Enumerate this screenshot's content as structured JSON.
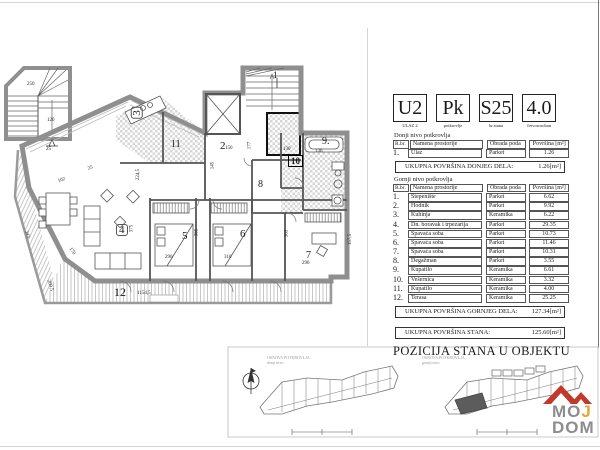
{
  "header": {
    "blocks": [
      {
        "big": "U2",
        "caption": "ULAZ 2"
      },
      {
        "big": "Pk",
        "caption": "potkrovlje"
      },
      {
        "big": "S25",
        "caption": "br.stana"
      },
      {
        "big": "4.0",
        "caption": "četvorosoban"
      }
    ]
  },
  "tables": {
    "columns": [
      "R.br.",
      "Namena prostorije",
      "Obrada poda",
      "Površina [m²]"
    ],
    "lower": {
      "section_title": "Donji nivo potkrovlja",
      "rows": [
        {
          "num": "1.",
          "name": "Ulaz",
          "floor": "Parket",
          "area": "1.26"
        }
      ],
      "total_label": "UKUPNA POVRŠINA DONJEG DELA:",
      "total_value": "1.26[m²]"
    },
    "upper": {
      "section_title": "Gornji nivo potkrovlja",
      "rows": [
        {
          "num": "1.",
          "name": "Stepenište",
          "floor": "Parket",
          "area": "6.62"
        },
        {
          "num": "2.",
          "name": "Hodnik",
          "floor": "Parket",
          "area": "9.92"
        },
        {
          "num": "3.",
          "name": "Kuhinja",
          "floor": "Keramika",
          "area": "6.22"
        },
        {
          "num": "4.",
          "name": "Dn. boravak i trpezarija",
          "floor": "Parket",
          "area": "29.35"
        },
        {
          "num": "5.",
          "name": "Spavaća soba",
          "floor": "Parket",
          "area": "10.73"
        },
        {
          "num": "6.",
          "name": "Spavaća soba",
          "floor": "Parket",
          "area": "11.46"
        },
        {
          "num": "7.",
          "name": "Spavaća soba",
          "floor": "Parket",
          "area": "10.31"
        },
        {
          "num": "8.",
          "name": "Degažman",
          "floor": "Parket",
          "area": "3.55"
        },
        {
          "num": "9.",
          "name": "Kupatilo",
          "floor": "Keramika",
          "area": "6.61"
        },
        {
          "num": "10.",
          "name": "Vešernica",
          "floor": "Keramika",
          "area": "3.32"
        },
        {
          "num": "11.",
          "name": "Kupatilo",
          "floor": "Keramika",
          "area": "4.00"
        },
        {
          "num": "12.",
          "name": "Terasa",
          "floor": "Keramika",
          "area": "25.25"
        }
      ],
      "total_label": "UKUPNA POVRŠINA GORNJEG DELA:",
      "total_value": "127.34[m²]"
    },
    "grand_total": {
      "label": "UKUPNA POVRŠINA STANA:",
      "value": "125.60[m²]"
    }
  },
  "position_title": "POZICIJA STANA U OBJEKTU",
  "mini_plans": {
    "left_caption_line1": "OSNOVA POTKROVLJA",
    "left_caption_line2": "donji nivo",
    "right_caption_line1": "OSNOVA POTKROVLJA",
    "right_caption_line2": "gornji nivo"
  },
  "logo": {
    "line1": "MOJ",
    "line2": "DOM",
    "roof_color": "#c0392b",
    "text_color": "#8d8d8d",
    "accent_color": "#e8a33d"
  },
  "plan": {
    "room_labels": [
      {
        "n": "1",
        "x": 273,
        "y": 70,
        "s": 9
      },
      {
        "n": "2",
        "x": 220,
        "y": 141,
        "s": 11
      },
      {
        "n": "3",
        "x": 131,
        "y": 107,
        "s": 11,
        "r": -90,
        "box": true
      },
      {
        "n": "4",
        "x": 116,
        "y": 224,
        "s": 11,
        "box": true
      },
      {
        "n": "5",
        "x": 182,
        "y": 231,
        "s": 11
      },
      {
        "n": "6",
        "x": 240,
        "y": 229,
        "s": 11
      },
      {
        "n": "7",
        "x": 306,
        "y": 251,
        "s": 10
      },
      {
        "n": "8",
        "x": 258,
        "y": 180,
        "s": 10
      },
      {
        "n": "9.",
        "x": 322,
        "y": 137,
        "s": 10
      },
      {
        "n": "10",
        "x": 288,
        "y": 155,
        "s": 9,
        "boxbold": true
      },
      {
        "n": "11",
        "x": 171,
        "y": 140,
        "s": 10
      },
      {
        "n": "12",
        "x": 114,
        "y": 287,
        "s": 12
      }
    ],
    "dim_labels": [
      {
        "t": "250",
        "x": 27,
        "y": 82,
        "r": 0
      },
      {
        "t": "120",
        "x": 47,
        "y": 118,
        "r": 0
      },
      {
        "t": "25",
        "x": 46,
        "y": 147,
        "r": 0
      },
      {
        "t": "102",
        "x": 58,
        "y": 178,
        "r": -18
      },
      {
        "t": "25",
        "x": 88,
        "y": 166,
        "r": -18
      },
      {
        "t": "224,5",
        "x": 133,
        "y": 172,
        "r": -90
      },
      {
        "t": "375",
        "x": 128,
        "y": 226,
        "r": -90
      },
      {
        "t": "365",
        "x": 193,
        "y": 230,
        "r": -90
      },
      {
        "t": "363",
        "x": 283,
        "y": 231,
        "r": -90
      },
      {
        "t": "177",
        "x": 246,
        "y": 143,
        "r": -90
      },
      {
        "t": "145",
        "x": 209,
        "y": 163,
        "r": -90
      },
      {
        "t": "150",
        "x": 225,
        "y": 146,
        "r": 0
      },
      {
        "t": "130",
        "x": 283,
        "y": 147,
        "r": 0
      },
      {
        "t": "136",
        "x": 315,
        "y": 149,
        "r": 0
      },
      {
        "t": "290",
        "x": 165,
        "y": 255,
        "r": 0
      },
      {
        "t": "310",
        "x": 224,
        "y": 255,
        "r": 0
      },
      {
        "t": "290",
        "x": 302,
        "y": 261,
        "r": 0
      },
      {
        "t": "1154,5",
        "x": 137,
        "y": 291,
        "r": 0
      },
      {
        "t": "343",
        "x": 23,
        "y": 232,
        "r": 73
      },
      {
        "t": "209,5",
        "x": 44,
        "y": 283,
        "r": 73
      },
      {
        "t": "170",
        "x": 68,
        "y": 249,
        "r": 55
      },
      {
        "t": "157,5",
        "x": 345,
        "y": 237,
        "r": -90
      }
    ]
  }
}
